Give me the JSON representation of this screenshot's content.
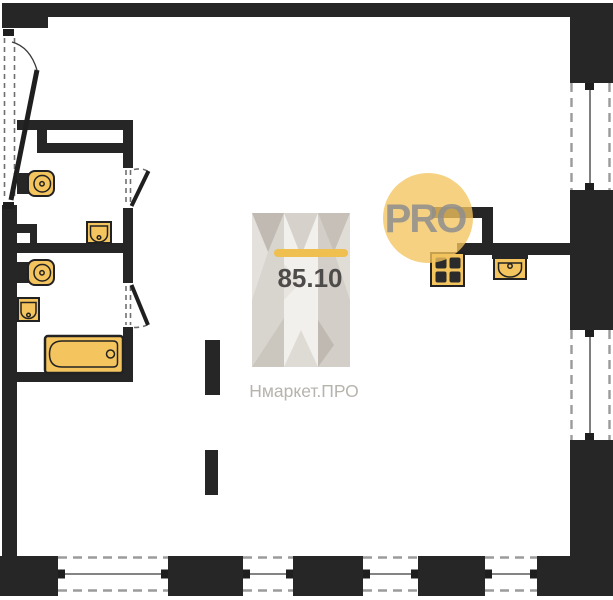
{
  "watermark": {
    "area": "85.10",
    "brand": "Нмаркет.ПРО",
    "badge": "PRO"
  },
  "plan": {
    "type": "floor-plan",
    "area_sqm": "85.10",
    "window_count": 6,
    "door_count": 3,
    "fixture_icons": [
      "toilet-icon",
      "toilet-icon",
      "washbasin-icon",
      "washbasin-icon",
      "bathtub-icon",
      "stove-icon",
      "kitchen-sink-icon"
    ],
    "column_count": 2
  },
  "colors": {
    "wall": "#262626",
    "fixture_fill": "#f4c45e",
    "fixture_stroke": "#222222",
    "badge_circle": "#f2c45e",
    "badge_text": "#8f8f8f",
    "accent_bar": "#efbf4f",
    "area_text": "#4e4c4a",
    "brand_text": "#b7b3ad",
    "background": "#ffffff"
  }
}
